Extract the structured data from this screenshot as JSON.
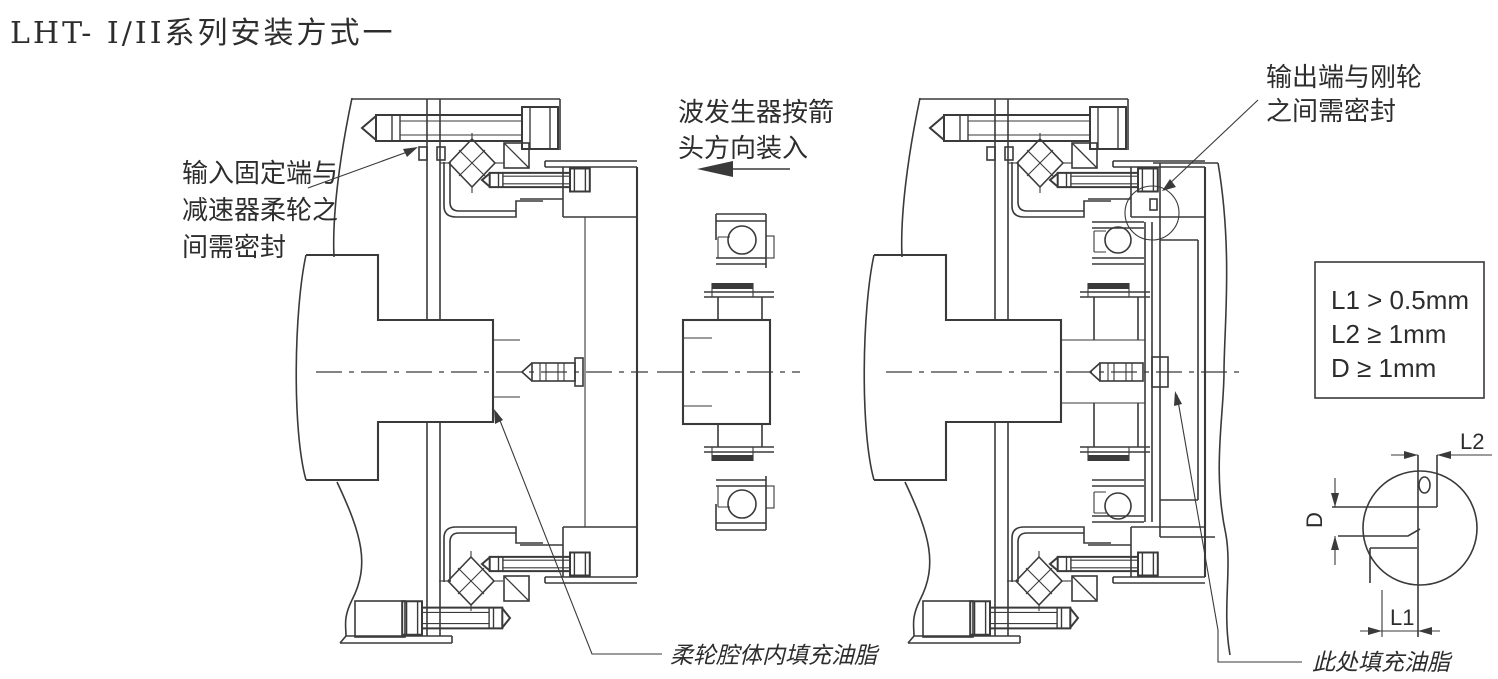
{
  "page": {
    "background": "#ffffff",
    "line_color": "#3a3a3a",
    "text_color": "#2d2d2d"
  },
  "title": "LHT- I/II系列安装方式一",
  "annotations": {
    "input_seal": [
      "输入固定端与",
      "减速器柔轮之",
      "间需密封"
    ],
    "wave_generator_install": [
      "波发生器按箭",
      "头方向装入"
    ],
    "output_seal": [
      "输出端与刚轮",
      "之间需密封"
    ],
    "flexspline_grease": "柔轮腔体内填充油脂",
    "grease_here": "此处填充油脂"
  },
  "spec_box": {
    "lines": [
      "L1 > 0.5mm",
      "L2 ≥ 1mm",
      "D ≥ 1mm"
    ]
  },
  "detail_view": {
    "dim_top": "L2",
    "dim_left": "D",
    "dim_bottom": "L1"
  }
}
